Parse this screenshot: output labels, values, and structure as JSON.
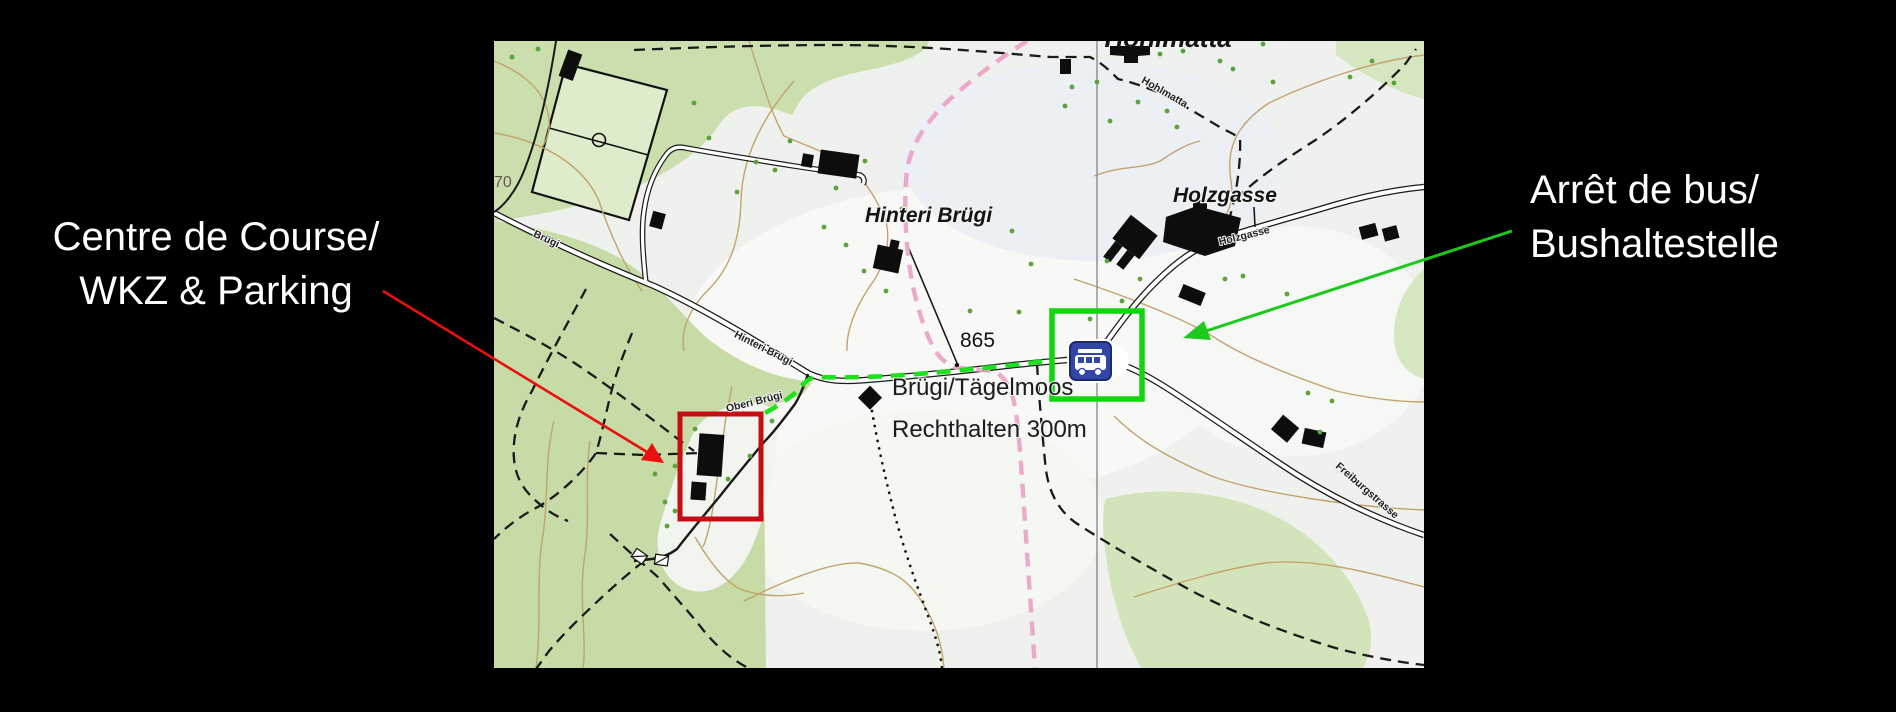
{
  "page": {
    "background": "#000000"
  },
  "annotations": {
    "left_label": {
      "line1": "Centre de Course/",
      "line2": "WKZ & Parking",
      "color": "#ffffff"
    },
    "right_label": {
      "line1": "Arrêt de bus/",
      "line2": "Bushaltestelle",
      "color": "#ffffff"
    },
    "red_arrow_color": "#ea1010",
    "green_arrow_color": "#1dc91d"
  },
  "map": {
    "highlight": {
      "red_box_color": "#c50d13",
      "green_box_color": "#0fd60f",
      "route_color": "#1ee11e"
    },
    "bus_icon": {
      "fill": "#3246a8",
      "border": "#1e2a6e"
    },
    "labels": {
      "top_place": "Hohlmatta",
      "place_hinteri_bruegi": "Hinteri Brügi",
      "place_holzgasse": "Holzgasse",
      "street_bruegi": "Brügi",
      "street_hinteri_bruegi": "Hinteri Brügi",
      "street_oberi_bruegi": "Oberi Brügi",
      "street_hohlmatta": "Hohlmatta",
      "street_holzgasse": "Holzgasse",
      "street_freiburgstrasse": "Freiburgstrasse",
      "spot_height": "865",
      "contour_label": "70",
      "destination_line1": "Brügi/Tägelmoos",
      "destination_line2": "Rechthalten 300m"
    },
    "colors": {
      "base": "#eff1ee",
      "forest": "#cbdfae",
      "field": "#dfeccb",
      "contour": "#c2a36b",
      "trail_pink": "#e9a3c6",
      "tree_dot": "#5ba33c",
      "grid_line": "#8b8b8b",
      "road_casing": "#1a1a1a",
      "building": "#0d0d0d"
    }
  }
}
